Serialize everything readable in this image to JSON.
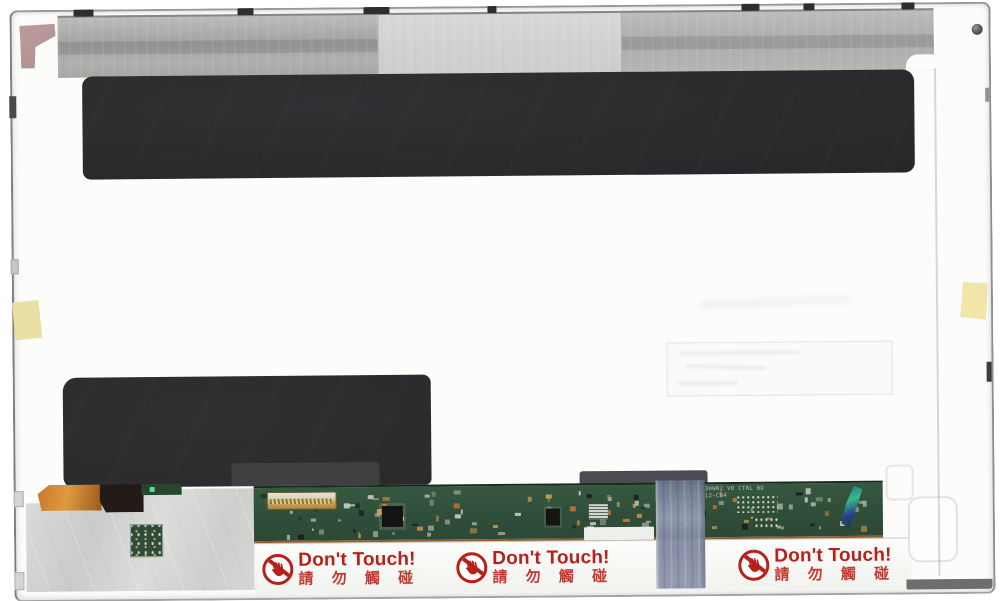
{
  "labels": {
    "warning": [
      {
        "en": "Don't Touch!",
        "zh": "請 勿 觸 碰"
      },
      {
        "en": "Don't Touch!",
        "zh": "請 勿 觸 碰"
      },
      {
        "en": "Don't Touch!",
        "zh": "請 勿 觸 碰"
      }
    ]
  },
  "pcb": {
    "silkscreen": {
      "line1": "B173HW02 V0 CTRL BD",
      "line2": "17B12-C04"
    }
  },
  "colors": {
    "warning_red": "#b7211c",
    "pcb_green": "#2f4e3a",
    "adhesive_black": "#2a2a2c",
    "metal_gray": "#aaaaa8",
    "shield_silver": "#d4d4d2",
    "tape_yellow": "#eadfa5",
    "tape_blue": "#8d95ab",
    "tape_pink": "#ad8a8c",
    "copper_edge": "#91602f",
    "component_palette": [
      "#c9c9bd",
      "#d9a04a",
      "#1b1b1b",
      "#cfd6cb",
      "#b0b8a8",
      "#d97b35",
      "#8f9a8a"
    ]
  }
}
